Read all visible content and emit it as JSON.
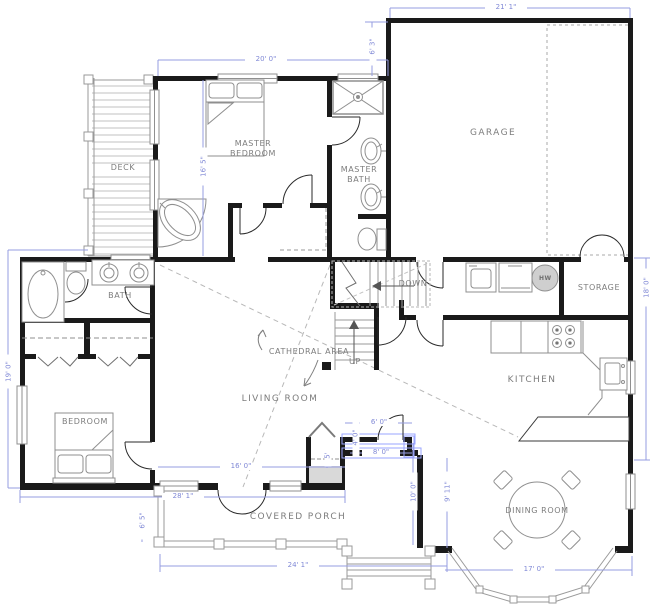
{
  "plan_title": "Home floor plan",
  "labels": {
    "deck": "DECK",
    "master_bedroom": "MASTER BEDROOM",
    "master_bath": "MASTER BATH",
    "garage": "GARAGE",
    "bath": "BATH",
    "down": "DOWN",
    "up": "UP",
    "storage": "STORAGE",
    "hot_water": "HW",
    "cathedral": "CATHEDRAL AREA",
    "living_room": "LIVING ROOM",
    "kitchen": "KITCHEN",
    "bedroom": "BEDROOM",
    "dining_room": "DINING ROOM",
    "covered_porch": "COVERED PORCH"
  },
  "dims": {
    "master_width": "20' 0\"",
    "garage_width": "21' 1\"",
    "garage_setback": "6' 3\"",
    "deck_length": "16' 5\"",
    "left_height": "19' 0\"",
    "right_height": "18' 0\"",
    "living_width": "16' 0\"",
    "nook_width": "6' 0\"",
    "nook_width2": "8' 0\"",
    "nook_depth": "4' 0\"",
    "fireplace_width": "5'",
    "dining_depth": "10' 0\"",
    "dining_depth2": "9' 11\"",
    "house_width": "28' 1\"",
    "porch_depth": "6' 5\"",
    "porch_width": "24' 1\"",
    "dining_width": "17' 0\""
  },
  "colors": {
    "wall": "#1a1a1a",
    "fixture": "#8f8f8f",
    "dimension": "#8089d6",
    "label": "#7d7d7d",
    "deck_plank": "#c2c2c2",
    "selection": "#9aa4ff"
  }
}
